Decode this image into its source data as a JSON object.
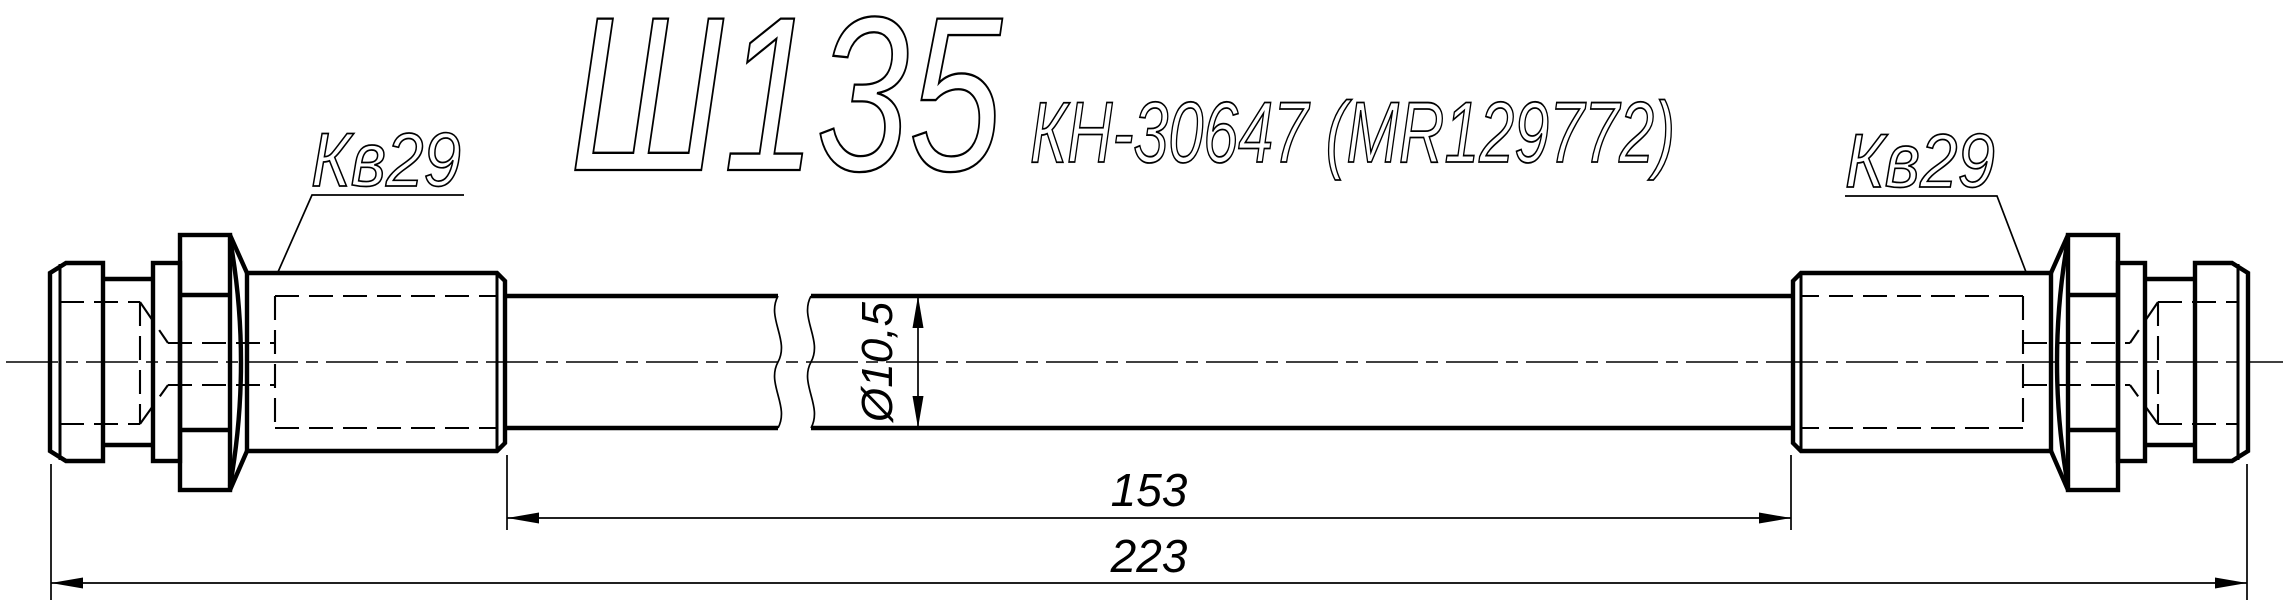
{
  "drawing": {
    "title": "Ш135",
    "part_code": "КН-30647 (MR129772)",
    "labels": {
      "left_thread": "Кв29",
      "right_thread": "Кв29"
    },
    "dimensions": {
      "hose_outer_diameter": "Ø10,5",
      "free_hose_length": "153",
      "overall_length": "223"
    },
    "colors": {
      "line": "#000000",
      "background": "#ffffff"
    }
  }
}
